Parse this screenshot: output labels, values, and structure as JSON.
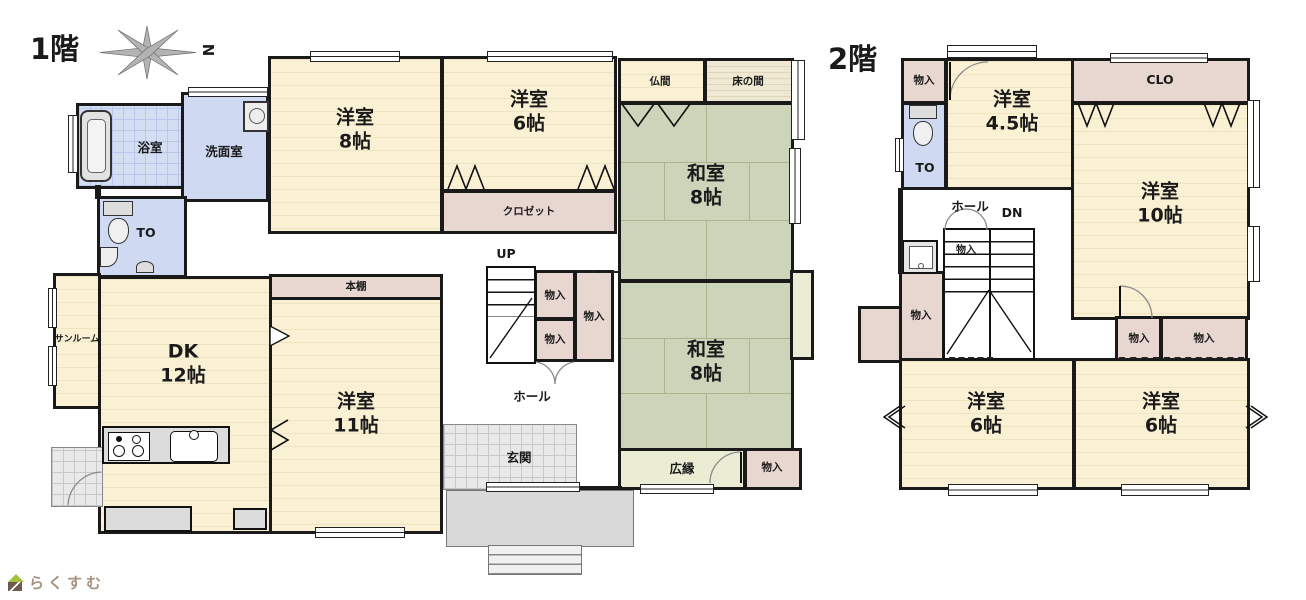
{
  "palette": {
    "wall": "#1a1a1a",
    "western_room": "#faf1d5",
    "tatami_room": "#ccd5ba",
    "storage": "#e8d6d0",
    "wet_area": "#cfdaf2",
    "engawa": "#eaecd4",
    "tokonoma": "#efe9d3",
    "paving": "#d9d9d9",
    "logo_text_color": "#a8917e",
    "logo_roof_color": "#a6c23c"
  },
  "floor1": {
    "title": "1階",
    "compass_n": "N",
    "bath": "浴室",
    "washroom": "洗面室",
    "toilet": "TO",
    "west8_name": "洋室",
    "west8_size": "8帖",
    "west6_name": "洋室",
    "west6_size": "6帖",
    "closet": "クロゼット",
    "butsuma": "仏間",
    "tokonoma": "床の間",
    "washitsu_a_name": "和室",
    "washitsu_a_size": "8帖",
    "washitsu_b_name": "和室",
    "washitsu_b_size": "8帖",
    "hiroen": "広縁",
    "monoiri_corner": "物入",
    "sunroom": "サンルーム",
    "dk_name": "DK",
    "dk_size": "12帖",
    "west11_name": "洋室",
    "west11_size": "11帖",
    "bookshelf": "本棚",
    "stairs_up": "UP",
    "monoiri_stair_1": "物入",
    "monoiri_stair_2": "物入",
    "monoiri_stair_3": "物入",
    "hall": "ホール",
    "genkan": "玄関"
  },
  "floor2": {
    "title": "2階",
    "monoiri_top": "物入",
    "toilet": "TO",
    "west45_name": "洋室",
    "west45_size": "4.5帖",
    "clo": "CLO",
    "west10_name": "洋室",
    "west10_size": "10帖",
    "hall": "ホール",
    "stairs_down": "DN",
    "monoiri_stair": "物入",
    "monoiri_left": "物入",
    "monoiri_mid_1": "物入",
    "monoiri_mid_2": "物入",
    "west6a_name": "洋室",
    "west6a_size": "6帖",
    "west6b_name": "洋室",
    "west6b_size": "6帖"
  },
  "branding": {
    "logo_text": "らくすむ"
  }
}
